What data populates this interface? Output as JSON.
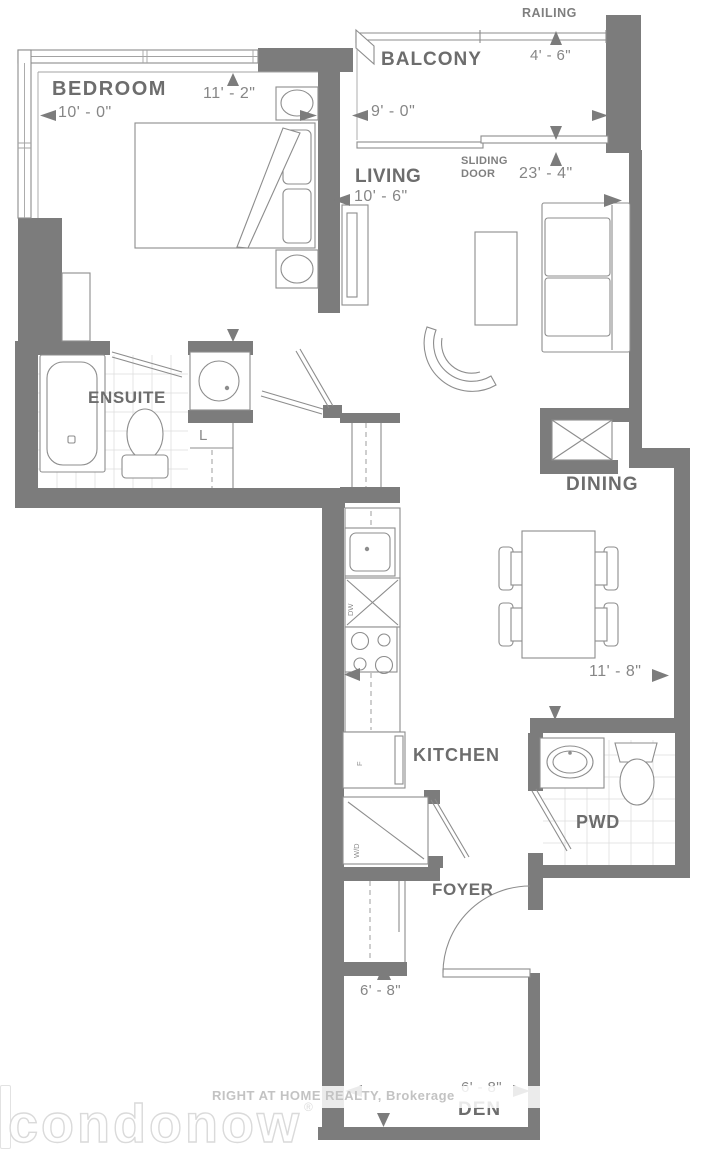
{
  "rooms": {
    "bedroom": {
      "label": "BEDROOM",
      "width": "10' - 0\"",
      "depth": "11' - 2\""
    },
    "balcony": {
      "label": "BALCONY",
      "width": "9' - 0\"",
      "depth": "4' - 6\"",
      "railing_label": "RAILING"
    },
    "living": {
      "label": "LIVING",
      "width": "10' - 6\"",
      "length": "23' - 4\"",
      "sliding_door_label": "SLIDING\nDOOR"
    },
    "ensuite": {
      "label": "ENSUITE",
      "linen_label": "L"
    },
    "dining": {
      "label": "DINING",
      "width": "11' - 8\""
    },
    "kitchen": {
      "label": "KITCHEN",
      "dishwasher_label": "DW",
      "fridge_label": "F",
      "washer_dryer_label": "W/D"
    },
    "pwd": {
      "label": "PWD"
    },
    "foyer": {
      "label": "FOYER",
      "closet_width": "6' - 8\""
    },
    "den": {
      "label": "DEN",
      "width": "6' - 8\""
    }
  },
  "watermarks": {
    "logo": "condonow",
    "registered": "®",
    "brokerage": "RIGHT AT HOME REALTY, Brokerage"
  },
  "colors": {
    "wall": "#7c7c7c",
    "line": "#8d8d8d",
    "room_label": "#6d6d6d",
    "dimension_label": "#868686",
    "tile": "#dedede",
    "watermark": "#c3c3c3"
  }
}
